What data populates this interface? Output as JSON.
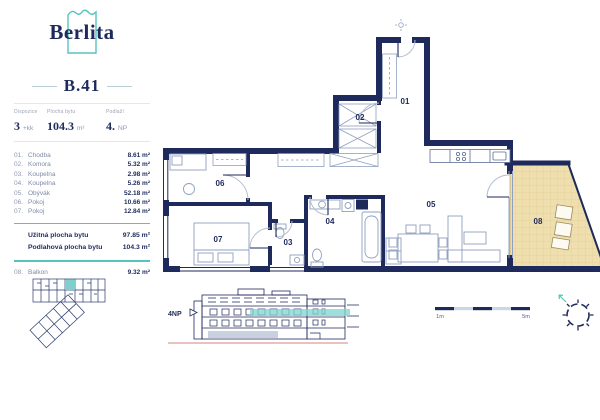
{
  "brand": {
    "name": "Berlita"
  },
  "unit": {
    "id": "B.41",
    "stats": [
      {
        "label": "Dispozice",
        "value": "3",
        "suffix": "+kk"
      },
      {
        "label": "Plocha bytu",
        "value": "104.3",
        "suffix": "m²"
      },
      {
        "label": "Podlaží",
        "value": "4.",
        "suffix": "NP"
      }
    ]
  },
  "rooms": [
    {
      "num": "01.",
      "name": "Chodba",
      "area": "8.61 m²"
    },
    {
      "num": "02.",
      "name": "Komora",
      "area": "5.32 m²"
    },
    {
      "num": "03.",
      "name": "Koupelna",
      "area": "2.98 m²"
    },
    {
      "num": "04.",
      "name": "Koupelna",
      "area": "5.26 m²"
    },
    {
      "num": "05.",
      "name": "Obývák",
      "area": "52.18 m²"
    },
    {
      "num": "06.",
      "name": "Pokoj",
      "area": "10.66 m²"
    },
    {
      "num": "07.",
      "name": "Pokoj",
      "area": "12.84 m²"
    }
  ],
  "summary": [
    {
      "label": "Užitná plocha bytu",
      "value": "97.85 m²"
    },
    {
      "label": "Podlahová plocha bytu",
      "value": "104.3 m²"
    }
  ],
  "balcony_row": {
    "num": "08.",
    "name": "Balkon",
    "area": "9.32 m²"
  },
  "plan_labels": {
    "r01": "01",
    "r02": "02",
    "r03": "03",
    "r04": "04",
    "r05": "05",
    "r06": "06",
    "r07": "07",
    "r08": "08"
  },
  "annotations": {
    "floor_marker": "4NP",
    "scale_min": "1m",
    "scale_max": "5m"
  },
  "colors": {
    "navy": "#1e2a5c",
    "teal": "#56c4bd",
    "balcony_fill": "#efdfae",
    "ground_line": "#dc9c98"
  }
}
